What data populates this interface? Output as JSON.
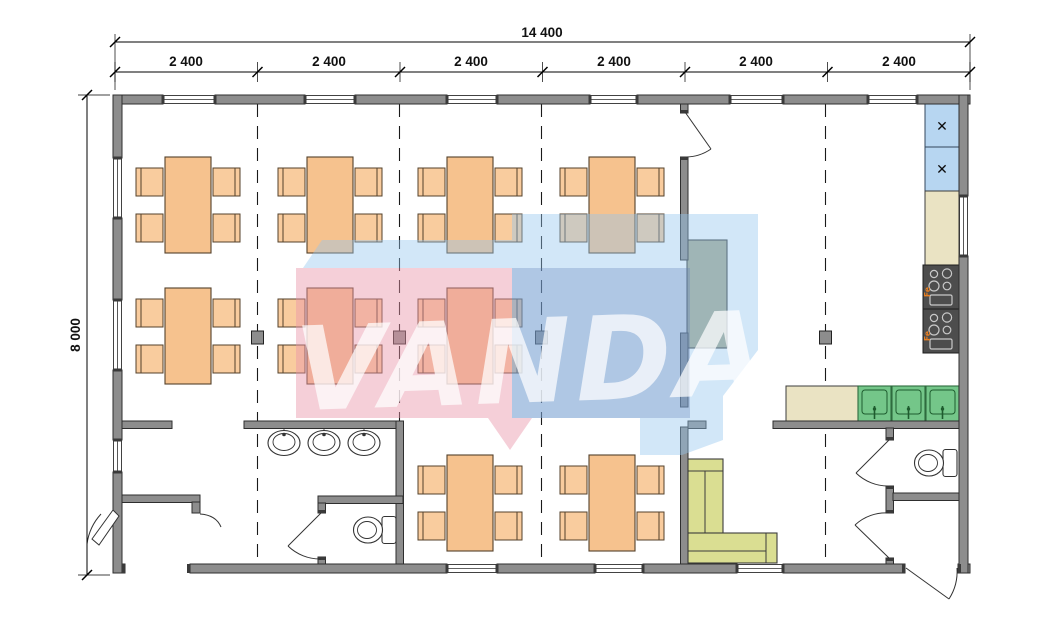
{
  "title": "Modular building floor plan",
  "watermark": {
    "text": "VANDA"
  },
  "dimensions": {
    "total": "14 400",
    "height": "8 000",
    "modules": [
      "2 400",
      "2 400",
      "2 400",
      "2 400",
      "2 400",
      "2 400"
    ]
  },
  "kitchen": {
    "stove_label": "Fe",
    "fridge_symbol": "✕"
  },
  "icons": {
    "fridge_symbol": "fan-cross-icon",
    "stove": "four-burner-stove-icon",
    "sink": "kitchen-sink-icon",
    "washbasin": "washbasin-icon",
    "toilet": "toilet-icon"
  },
  "colors": {
    "wall": "#8d8d8d",
    "table": "#f6c28e",
    "chair": "#f9cc9e",
    "counter": "#eae3c3",
    "serving_counter": "#a8aa8e",
    "fridge": "#b7d6f1",
    "stove": "#4d4d4d",
    "sink": "#74c689",
    "sofa": "#dade92",
    "watermark_pink": "rgba(233,148,168,0.45)",
    "watermark_blue": "rgba(95,125,182,0.30)",
    "watermark_lightblue": "rgba(148,198,238,0.42)"
  }
}
